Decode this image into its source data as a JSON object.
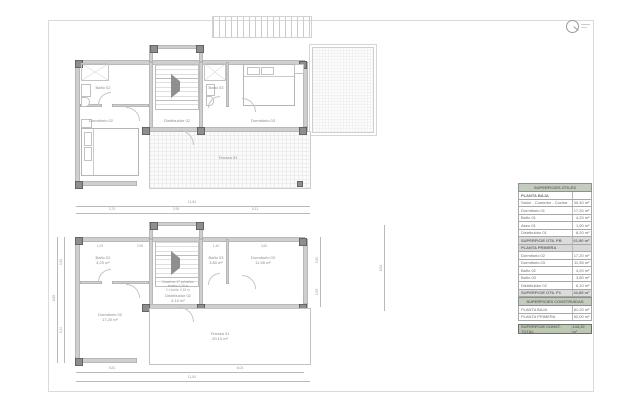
{
  "colors": {
    "wall": "#cfcfcf",
    "column": "#8e8e8e",
    "table_header_green": "#c3ccbd",
    "table_total_green": "#bcc9b0",
    "table_subtotal_gray": "#dcdcdc",
    "text_gray": "#8a8a8a"
  },
  "plan_top": {
    "rooms": {
      "bath2": "Baño 02",
      "bath3": "Baño 03",
      "bed2": "Dormitorio 02",
      "bed3": "Dormitorio 03",
      "hall": "Distribuidor 02",
      "terrace": "Terraza 01"
    }
  },
  "plan_bottom": {
    "rooms": {
      "bath2": {
        "name": "Baño 02",
        "area": "4,20 m²"
      },
      "bath3": {
        "name": "Baño 03",
        "area": "3,80 m²"
      },
      "bed2": {
        "name": "Dormitorio 02",
        "area": "17,20 m²"
      },
      "bed3": {
        "name": "Dormitorio 03",
        "area": "11,55 m²"
      },
      "hall": {
        "name": "Distribuidor 02",
        "area": "6,10 m²"
      },
      "terrace": {
        "name": "Terraza 01",
        "area": "20,10 m²"
      }
    },
    "stair_note": [
      "Escalera: 17 peldaños",
      "Huella: 0,28 m",
      "C.Huella: 0,18 m"
    ],
    "dims": {
      "top": [
        "3,70",
        "2,90",
        "5,11"
      ],
      "top_overall": "11,84",
      "inner_top": [
        "1,02",
        "2,90",
        "1,40",
        "3,60"
      ],
      "left": [
        "3,52",
        "5,10"
      ],
      "left_overall": "8,85",
      "right": [
        "5,90",
        "2,95"
      ],
      "far_right": "8,62",
      "bottom": [
        "5,81",
        "6,03"
      ],
      "bottom_overall": "11,84"
    }
  },
  "tables": {
    "useful": {
      "title": "SUPERFICIES ÚTILES",
      "pb_header": "PLANTA BAJA",
      "pb_rows": [
        {
          "label": "Salón - Comedor - Cocina",
          "value": "30,40 m²"
        },
        {
          "label": "Dormitorio 01",
          "value": "17,20 m²"
        },
        {
          "label": "Baño 01",
          "value": "4,20 m²"
        },
        {
          "label": "Aseo 01",
          "value": "1,90 m²"
        },
        {
          "label": "Distribuidor 01",
          "value": "8,20 m²"
        }
      ],
      "pb_total_label": "SUPERFICIE ÚTIL PB",
      "pb_total": "61,90 m²",
      "p1_header": "PLANTA PRIMERA",
      "p1_rows": [
        {
          "label": "Dormitorio 02",
          "value": "17,20 m²"
        },
        {
          "label": "Dormitorio 03",
          "value": "11,55 m²"
        },
        {
          "label": "Baño 02",
          "value": "4,20 m²"
        },
        {
          "label": "Baño 03",
          "value": "3,80 m²"
        },
        {
          "label": "Distribuidor 02",
          "value": "6,10 m²"
        }
      ],
      "p1_total_label": "SUPERFICIE ÚTIL P1",
      "p1_total": "42,85 m²",
      "total_label": "SUPERFICIE ÚTIL TOTAL",
      "total": "104,75 m²"
    },
    "built": {
      "title": "SUPERFICIES CONSTRUIDAS",
      "rows": [
        {
          "label": "PLANTA BAJA",
          "value": "81,20 m²"
        },
        {
          "label": "PLANTA PRIMERA",
          "value": "62,00 m²"
        }
      ],
      "total_label": "SUPERFICIE CONST. TOTAL",
      "total": "143,20 m²"
    }
  }
}
